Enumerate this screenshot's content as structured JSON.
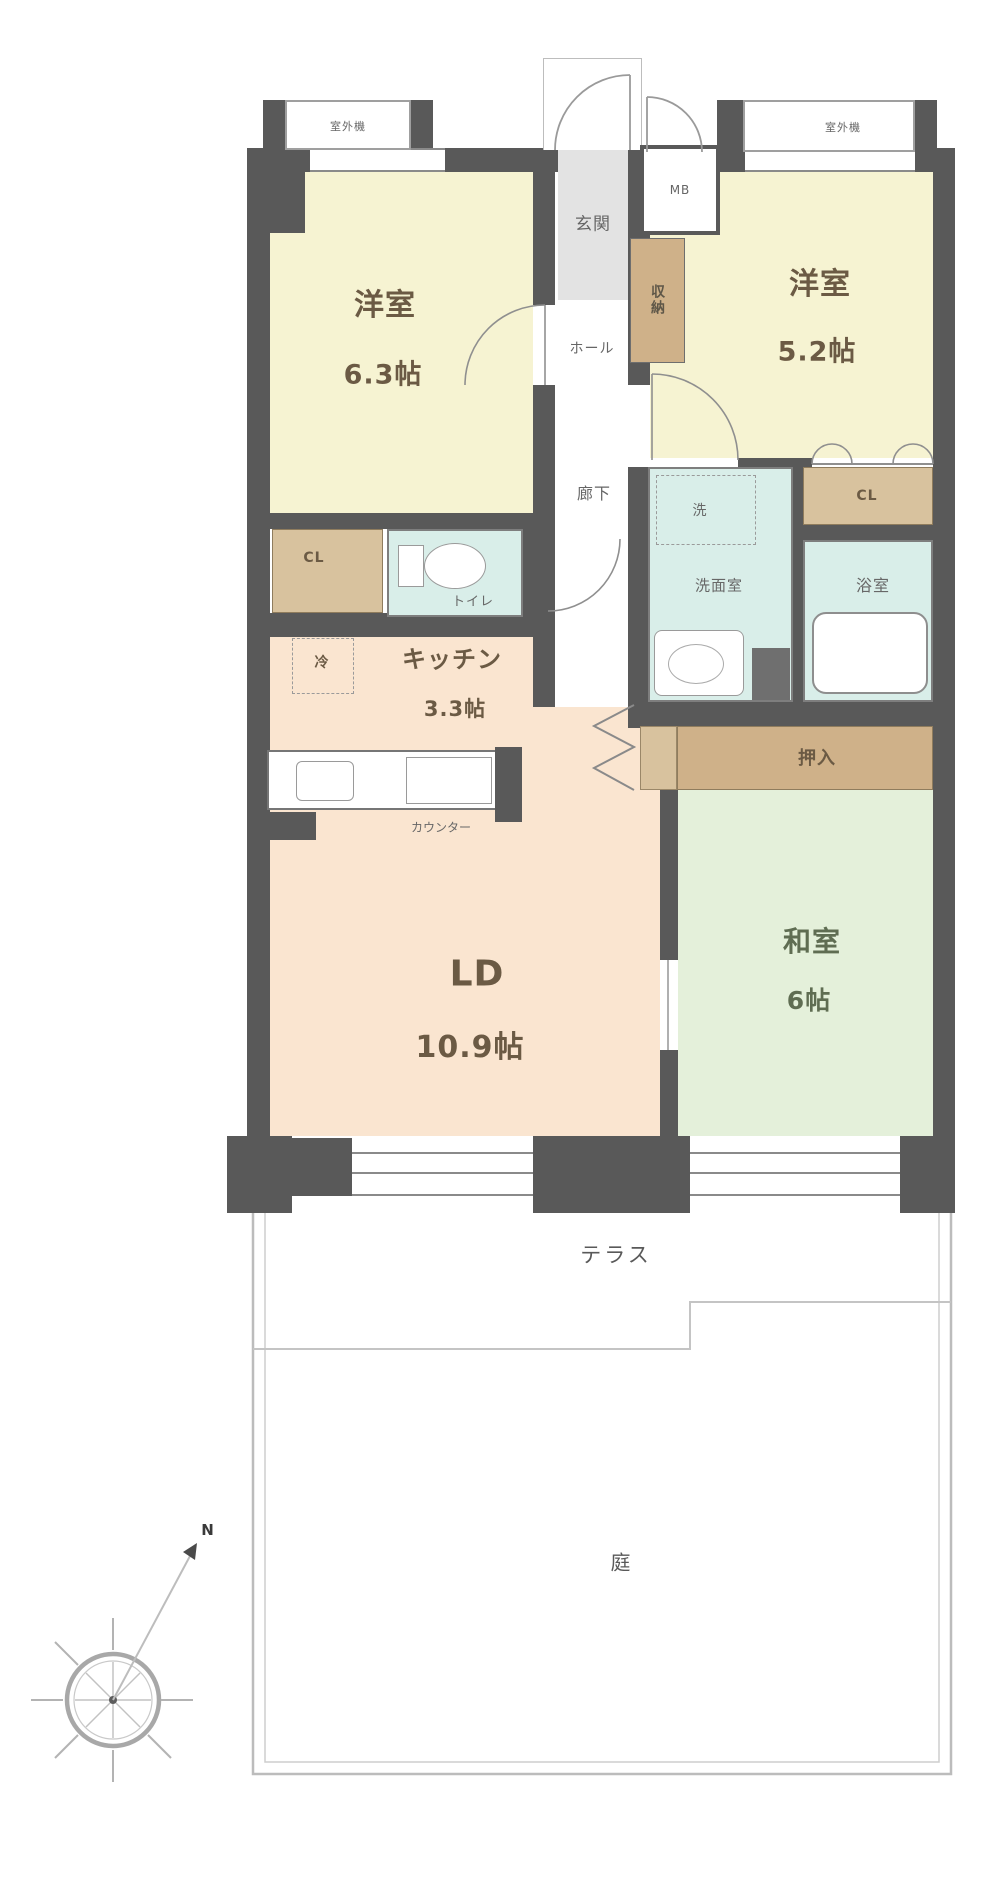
{
  "floor_plan": {
    "rooms": {
      "western1": {
        "name": "洋室",
        "size": "6.3帖"
      },
      "western2": {
        "name": "洋室",
        "size": "5.2帖"
      },
      "kitchen": {
        "name": "キッチン",
        "size": "3.3帖"
      },
      "living_dining": {
        "name": "LD",
        "size": "10.9帖"
      },
      "japanese": {
        "name": "和室",
        "size": "6帖"
      }
    },
    "labels": {
      "genkan": "玄関",
      "hall": "ホール",
      "corridor": "廊下",
      "toilet": "トイレ",
      "closet_left": "CL",
      "closet_right": "CL",
      "storage": "収納",
      "oshiire": "押入",
      "washroom": "洗面室",
      "bath": "浴室",
      "laundry": "洗",
      "fridge": "冷",
      "counter": "カウンター",
      "meter_box": "MB",
      "outdoor_unit_left": "室外機",
      "outdoor_unit_right": "室外機",
      "terrace": "テラス",
      "garden": "庭",
      "north": "N"
    },
    "colors": {
      "wall": "#595959",
      "western_room": "#f6f3d2",
      "living_kitchen": "#fae5d0",
      "japanese_room": "#e4f0da",
      "wet_room": "#d9eee9",
      "closet": "#cfb189",
      "closet_light": "#d8c29e",
      "genkan": "#e3e3e3"
    }
  }
}
